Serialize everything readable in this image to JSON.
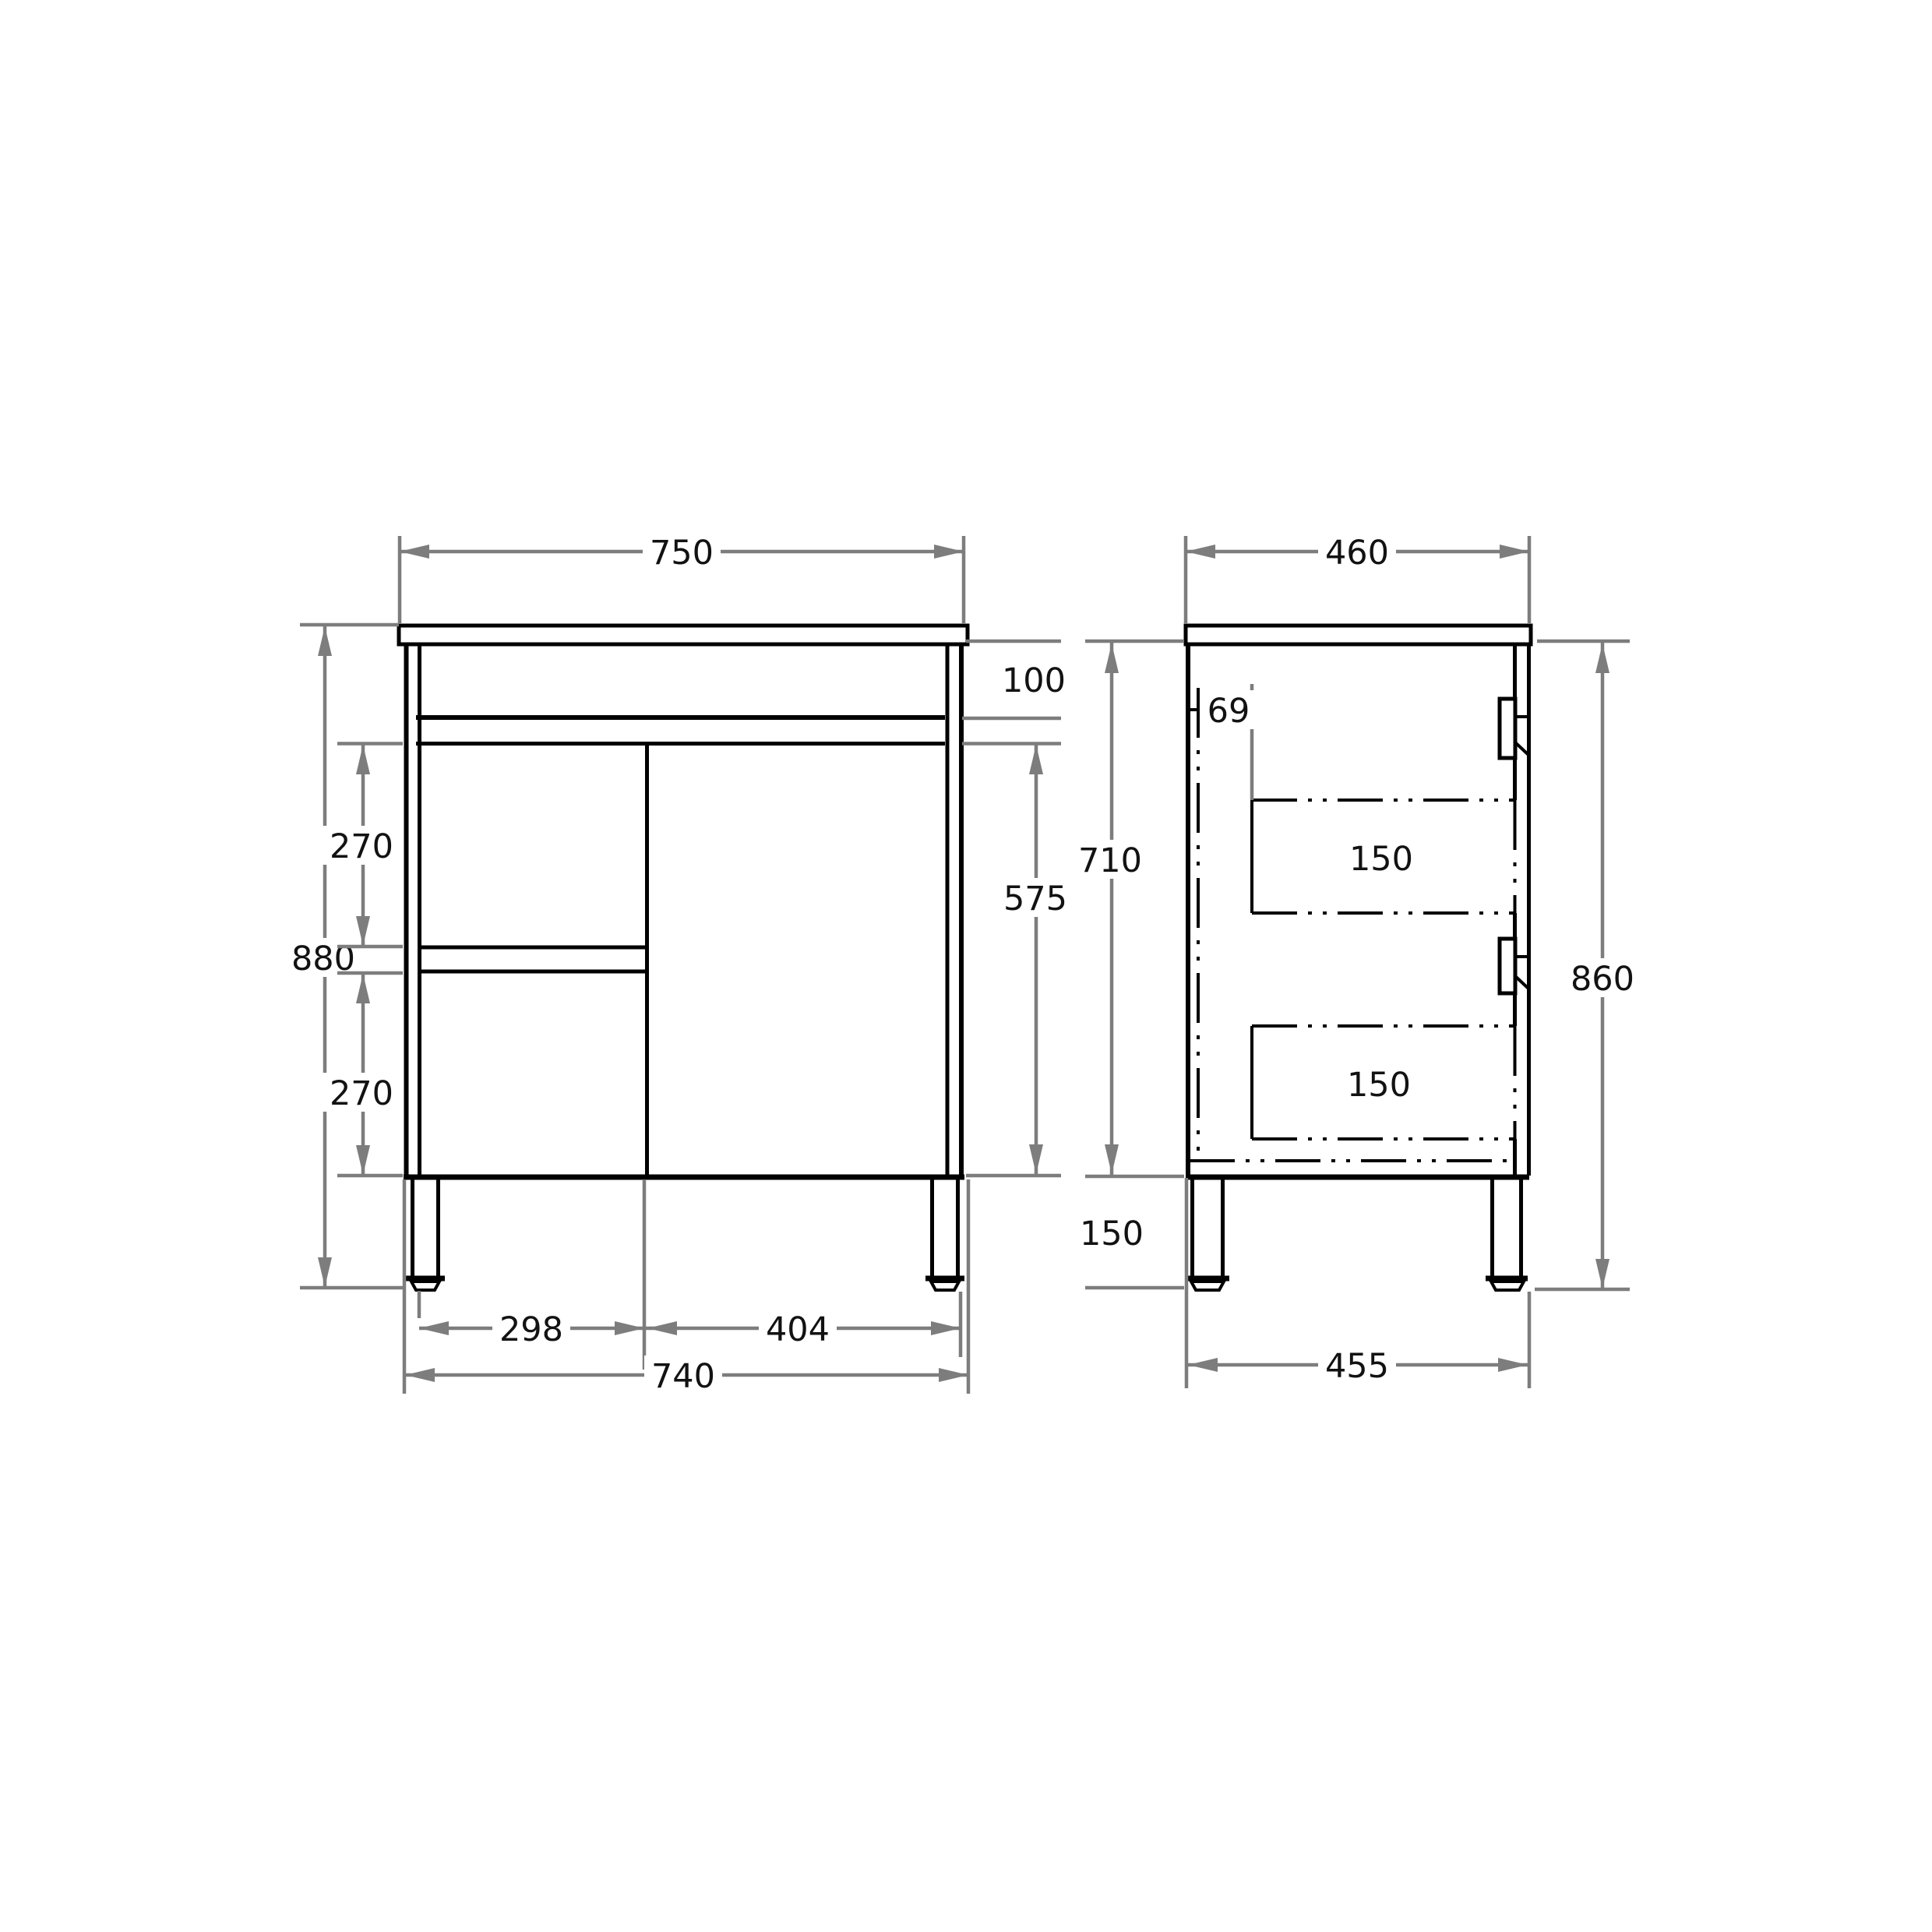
{
  "drawing": {
    "kind": "cabinet-vanity-technical-drawing",
    "units": "mm",
    "colors": {
      "object_line": "#000000",
      "dimension_line": "#7d7d7d",
      "text": "#121212",
      "background": "#ffffff"
    },
    "views": {
      "front": {
        "name": "front view",
        "dimensions": {
          "top_width": "750",
          "apron_height": "100",
          "door_height": "575",
          "overall_height": "880",
          "upper_drawer_height": "270",
          "lower_drawer_height": "270",
          "drawer_bank_width": "298",
          "door_width": "404",
          "carcass_width": "740"
        }
      },
      "side": {
        "name": "side view",
        "dimensions": {
          "top_depth": "460",
          "back_offset": "69",
          "carcass_height": "710",
          "upper_drawer_depth": "150",
          "lower_drawer_depth": "150",
          "leg_height": "150",
          "base_depth": "455",
          "overall_height": "860"
        }
      }
    }
  }
}
